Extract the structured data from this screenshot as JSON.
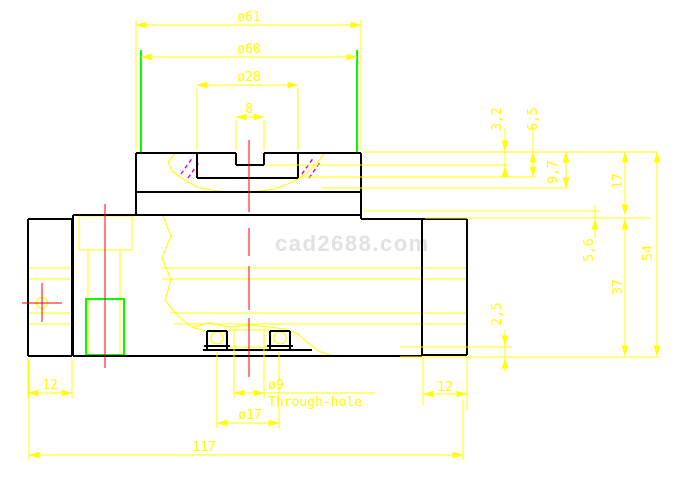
{
  "watermark": "cad2688.com",
  "colors": {
    "background": "#ffffff",
    "dimension": "#ffff00",
    "outline": "#000000",
    "centerline": "#ff0000",
    "highlight": "#00ff00",
    "hatch": "#cc00cc",
    "watermark": "#e2e2e2"
  },
  "dims": {
    "dia61": "ø61",
    "dia60": "ø60",
    "dia28": "ø28",
    "slot_width_8": "8",
    "depth_3_2": "3,2",
    "depth_6_5": "6,5",
    "depth_9_7": "9,7",
    "height_17": "17",
    "depth_5_6": "5,6",
    "height_37": "37",
    "height_54": "54",
    "depth_2_5": "2,5",
    "left_width_12": "12",
    "right_width_12": "12",
    "hole_dia_9": "ø9",
    "hole_note": "Through-hole",
    "counterbore_dia_17": "ø17",
    "total_length_117": "117"
  }
}
